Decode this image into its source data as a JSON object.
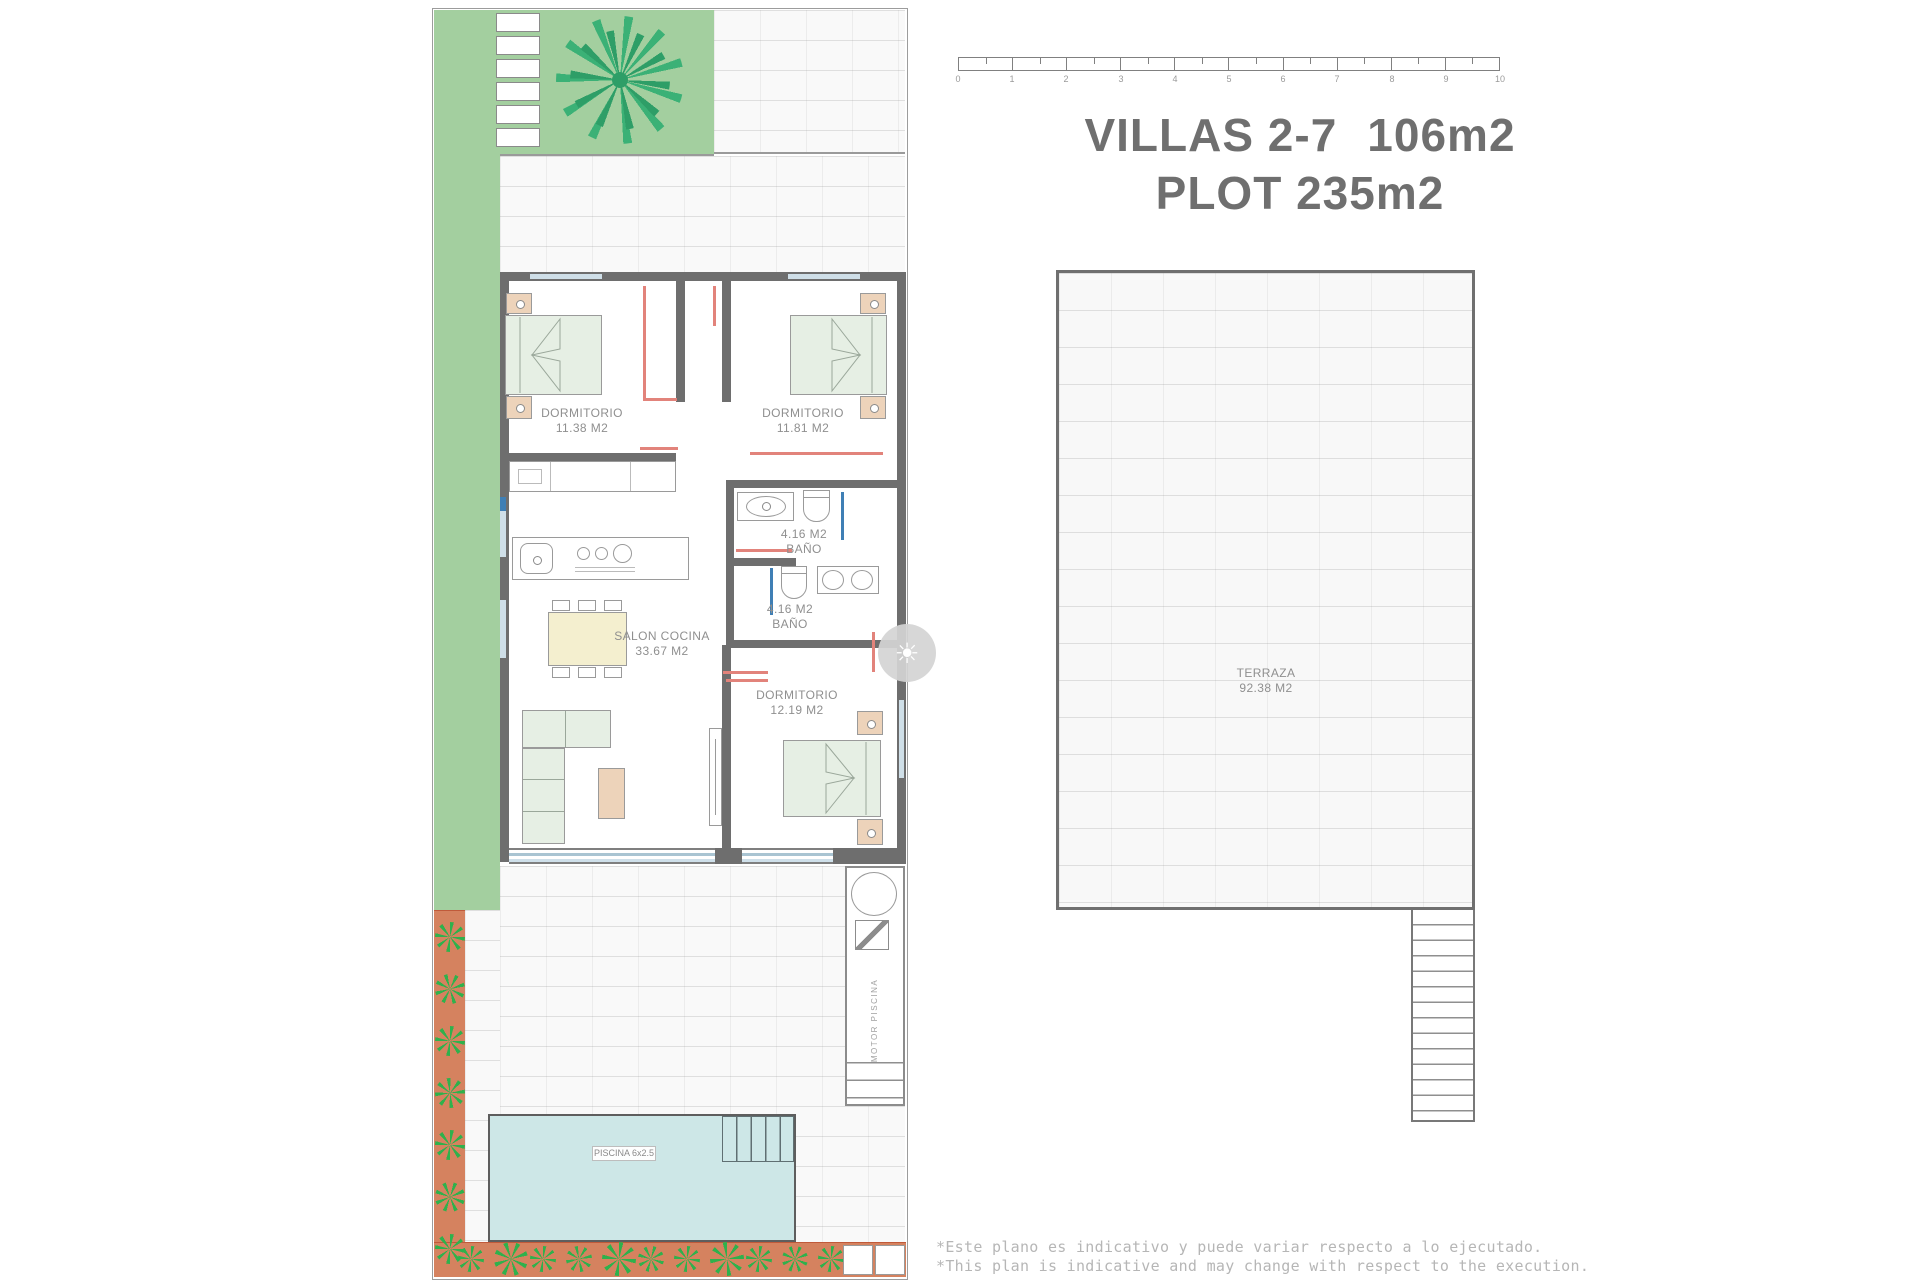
{
  "title": {
    "villas": "VILLAS 2-7",
    "area": "106m2",
    "plot": "PLOT 235m2"
  },
  "scalebar": {
    "ticks": [
      "0",
      "1",
      "2",
      "3",
      "4",
      "5",
      "6",
      "7",
      "8",
      "9",
      "10"
    ]
  },
  "plan": {
    "rooms": [
      {
        "id": "dormitorio-1",
        "name": "DORMITORIO",
        "area": "11.38 M2"
      },
      {
        "id": "dormitorio-2",
        "name": "DORMITORIO",
        "area": "11.81 M2"
      },
      {
        "id": "bano-1",
        "area": "4.16 M2",
        "name": "BAÑO"
      },
      {
        "id": "bano-2",
        "area": "4.16 M2",
        "name": "BAÑO"
      },
      {
        "id": "salon-cocina",
        "name": "SALON COCINA",
        "area": "33.67 M2"
      },
      {
        "id": "dormitorio-3",
        "name": "DORMITORIO",
        "area": "12.19 M2"
      }
    ],
    "pool_label": "PISCINA 6x2.5",
    "motor_label": "MOTOR  PISCINA"
  },
  "terrace": {
    "name": "TERRAZA",
    "area": "92.38 M2"
  },
  "footnotes": {
    "line1": "*Este plano es indicativo y puede variar respecto a lo ejecutado.",
    "line2": "*This plan is indicative and may change with respect to the execution."
  },
  "icons": {
    "watermark": "sun-icon",
    "tree": "palm-tree-icon",
    "shrub": "plant-icon"
  },
  "colors": {
    "garden_green": "#a3cf9f",
    "palm_green": "#3bb176",
    "plant_green": "#2fb14c",
    "terracotta": "#d5825f",
    "pool_blue": "#cde7e7",
    "wall_gray": "#6e6e6e",
    "accent_red": "#e2837b",
    "plumbing_blue": "#3f7fb5",
    "furniture_peach": "#edd3ba",
    "furniture_green": "#e6efe4",
    "label_gray": "#8f8f8f",
    "title_gray": "#6f6f6f",
    "footnote_gray": "#b6b6b6"
  }
}
